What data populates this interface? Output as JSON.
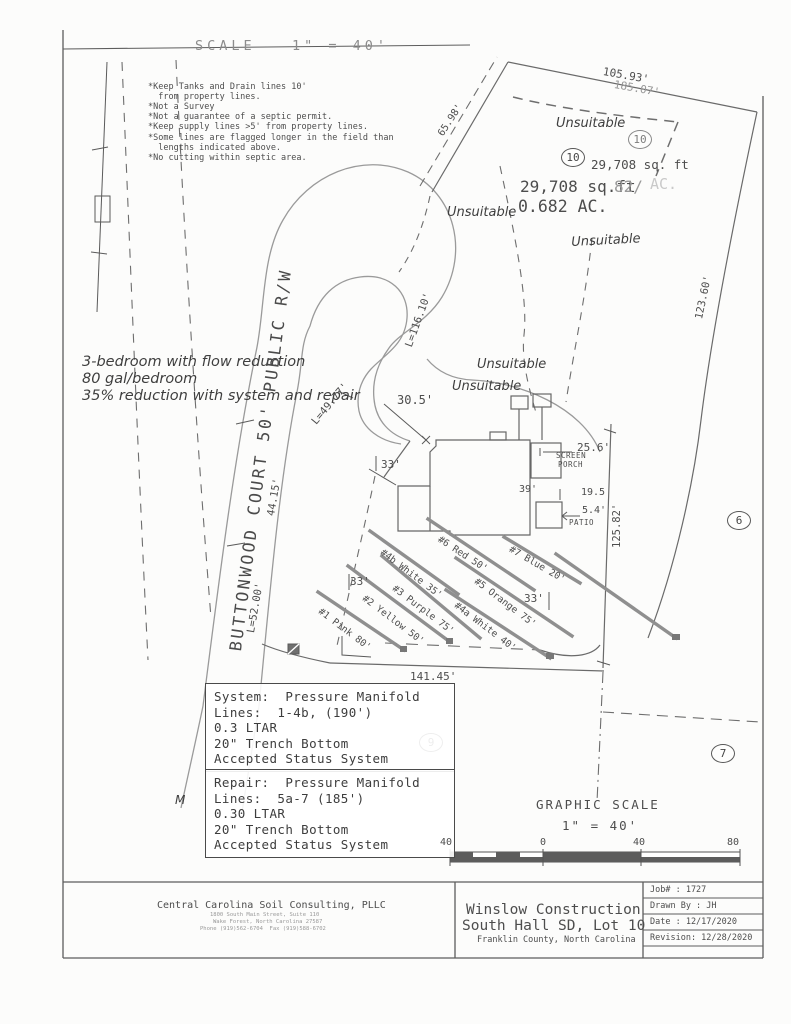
{
  "meta": {
    "scale_header": "SCALE   1\" = 40'"
  },
  "notes": [
    "*Keep Tanks and Drain lines 10'",
    "  from property lines.",
    "*Not a Survey",
    "*Not a guarantee of a septic permit.",
    "*Keep supply lines >5' from property lines.",
    "*Some lines are flagged longer in the field than",
    "  lengths indicated above.",
    "*No cutting within septic area."
  ],
  "handwritten": {
    "line1": "3-bedroom with flow reduction",
    "line2": "80 gal/bedroom",
    "line3": "35% reduction with system and repair"
  },
  "road": {
    "label": "BUTTONWOOD COURT 50' PUBLIC R/W"
  },
  "lot": {
    "number": "10",
    "unsuitable": "Unsuitable",
    "area_small": "29,708 sq. ft",
    "area_large": "29,708 sq.ft",
    "area_ghost_suffix": "82/",
    "area_ghost_ac": "AC.",
    "area_ac": "0.682 AC.",
    "adjacent_east": "6",
    "adjacent_south": "7"
  },
  "dimensions": {
    "top_primary": "105.93'",
    "top_ghost": "185.07'",
    "side_upper_left": "65.98'",
    "right_upper": "123.60'",
    "culdesac_arc": "L=116.10'",
    "stem_mid": "44.15'",
    "stem_lower": "L=52.00'",
    "bulb_exit": "L=49.77'",
    "road_to_house": "30.5'",
    "house_left": "33'",
    "screen_porch": "25.6'",
    "house_rear": "39'",
    "patio_offset": "19.5",
    "patio_width": "5.4'",
    "east_line": "125.82'",
    "field_left": "33'",
    "field_right": "33'",
    "bottom_line": "141.45'"
  },
  "structures": {
    "screen_porch_1": "SCREEN",
    "screen_porch_2": "PORCH",
    "patio": "PATIO"
  },
  "drain_lines": [
    {
      "label": "#1 Pink 80'"
    },
    {
      "label": "#2 Yellow 50'"
    },
    {
      "label": "#3 Purple 75'"
    },
    {
      "label": "#4a White 40'"
    },
    {
      "label": "#4b White 35'"
    },
    {
      "label": "#5 Orange 75'"
    },
    {
      "label": "#6 Red 50'"
    },
    {
      "label": "#7 Blue 20'"
    }
  ],
  "system_box": {
    "lot_circle": "9",
    "lines": [
      "System:  Pressure Manifold",
      "Lines:  1-4b, (190')",
      "0.3 LTAR",
      "20\" Trench Bottom",
      "Accepted Status System"
    ]
  },
  "repair_box": {
    "lines": [
      "Repair:  Pressure Manifold",
      "Lines:  5a-7 (185')",
      "0.30 LTAR",
      "20\" Trench Bottom",
      "Accepted Status System"
    ]
  },
  "graphic_scale": {
    "title": "GRAPHIC SCALE",
    "ratio": "1\" = 40'",
    "ticks": [
      "40",
      "0",
      "40",
      "80"
    ]
  },
  "title_block": {
    "company": {
      "name": "Central Carolina Soil Consulting, PLLC",
      "address1": "1800 South Main Street, Suite 110",
      "address2": "Wake Forest, North Carolina 27587",
      "phone": "Phone (919)562-6704  Fax (919)588-6702"
    },
    "project": {
      "line1": "Winslow Construction",
      "line2": "South Hall SD, Lot 10",
      "line3": "Franklin County, North Carolina"
    },
    "info": {
      "job": "Job# : 1727",
      "drawn": "Drawn By : JH",
      "date": "Date : 12/17/2020",
      "revision": "Revision: 12/28/2020"
    }
  },
  "stray": {
    "m": "M"
  }
}
